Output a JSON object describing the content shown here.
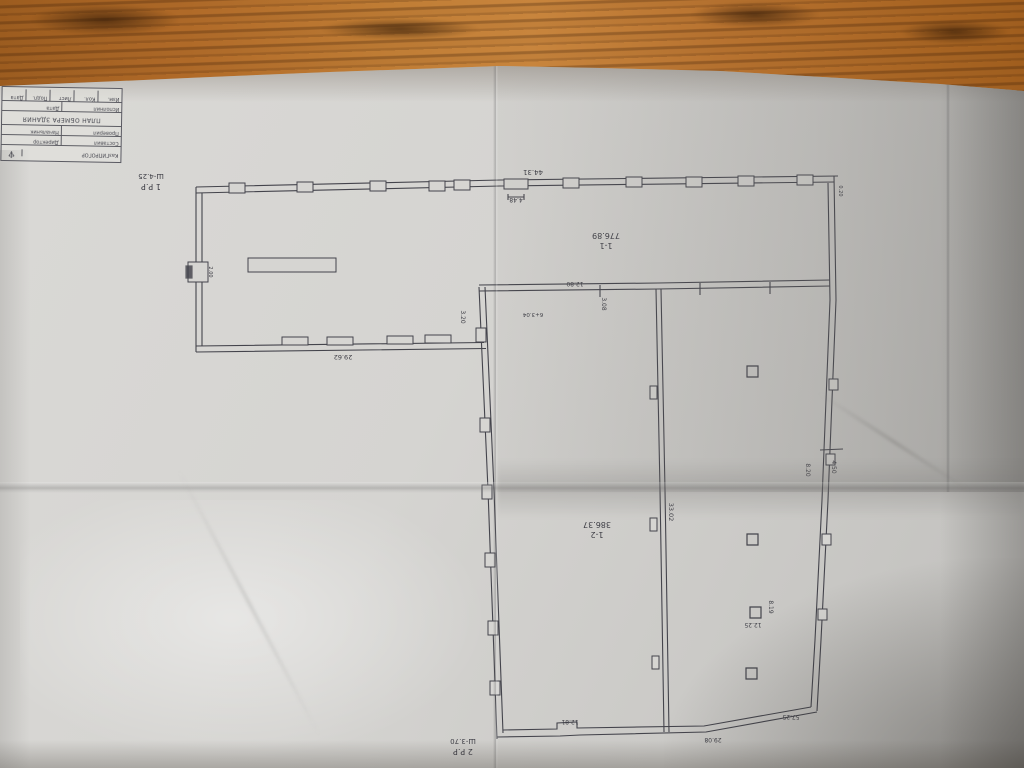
{
  "colors": {
    "wood": "#b06a28",
    "paper": "#d6d5d2",
    "ink": "#3f3f48"
  },
  "stamp": {
    "org": "КазГИПРОГОР",
    "logo_icon": "trident-logo",
    "logo_glyph": "♆",
    "row_names_a": {
      "c1": "Составил",
      "c2": "Директор"
    },
    "row_names_b": {
      "c1": "Проверил",
      "c2": "Начальник"
    },
    "title": "ПЛАН ОБМЕРА ЗДАНИЯ",
    "row_exec": {
      "c1": "Исполнил",
      "c2": "Дата"
    },
    "row_meta": {
      "c1": "Изм.",
      "c2": "Кол.",
      "c3": "Лист",
      "c4": "Подп.",
      "c5": "Дата"
    }
  },
  "marks": {
    "level1": {
      "line1": "1 Р.Р",
      "line2": "Ш-4.25"
    },
    "level2": {
      "line1": "2 Р.Р",
      "line2": "Ш-3.70"
    }
  },
  "rooms": {
    "r1": {
      "id": "1-1",
      "area": "776.89"
    },
    "r2": {
      "id": "1-2",
      "area": "386.37"
    }
  },
  "dims": {
    "top_width": "44.31",
    "top_opening": "4.48",
    "upper_wall": "12.80",
    "v_308": "3.08",
    "note_604": "6+3.04",
    "v_320": "3.20",
    "lower_strip": "29.62",
    "door_200": "2.00",
    "v_3302": "33.02",
    "v_820": "8.20",
    "v_450": "4.50",
    "v_819": "8.19",
    "col_1225": "12.25",
    "corner_5725": "57.25",
    "bottom_2908": "29.08",
    "bottom_1281": "12.81",
    "corner_020": "0.20"
  }
}
